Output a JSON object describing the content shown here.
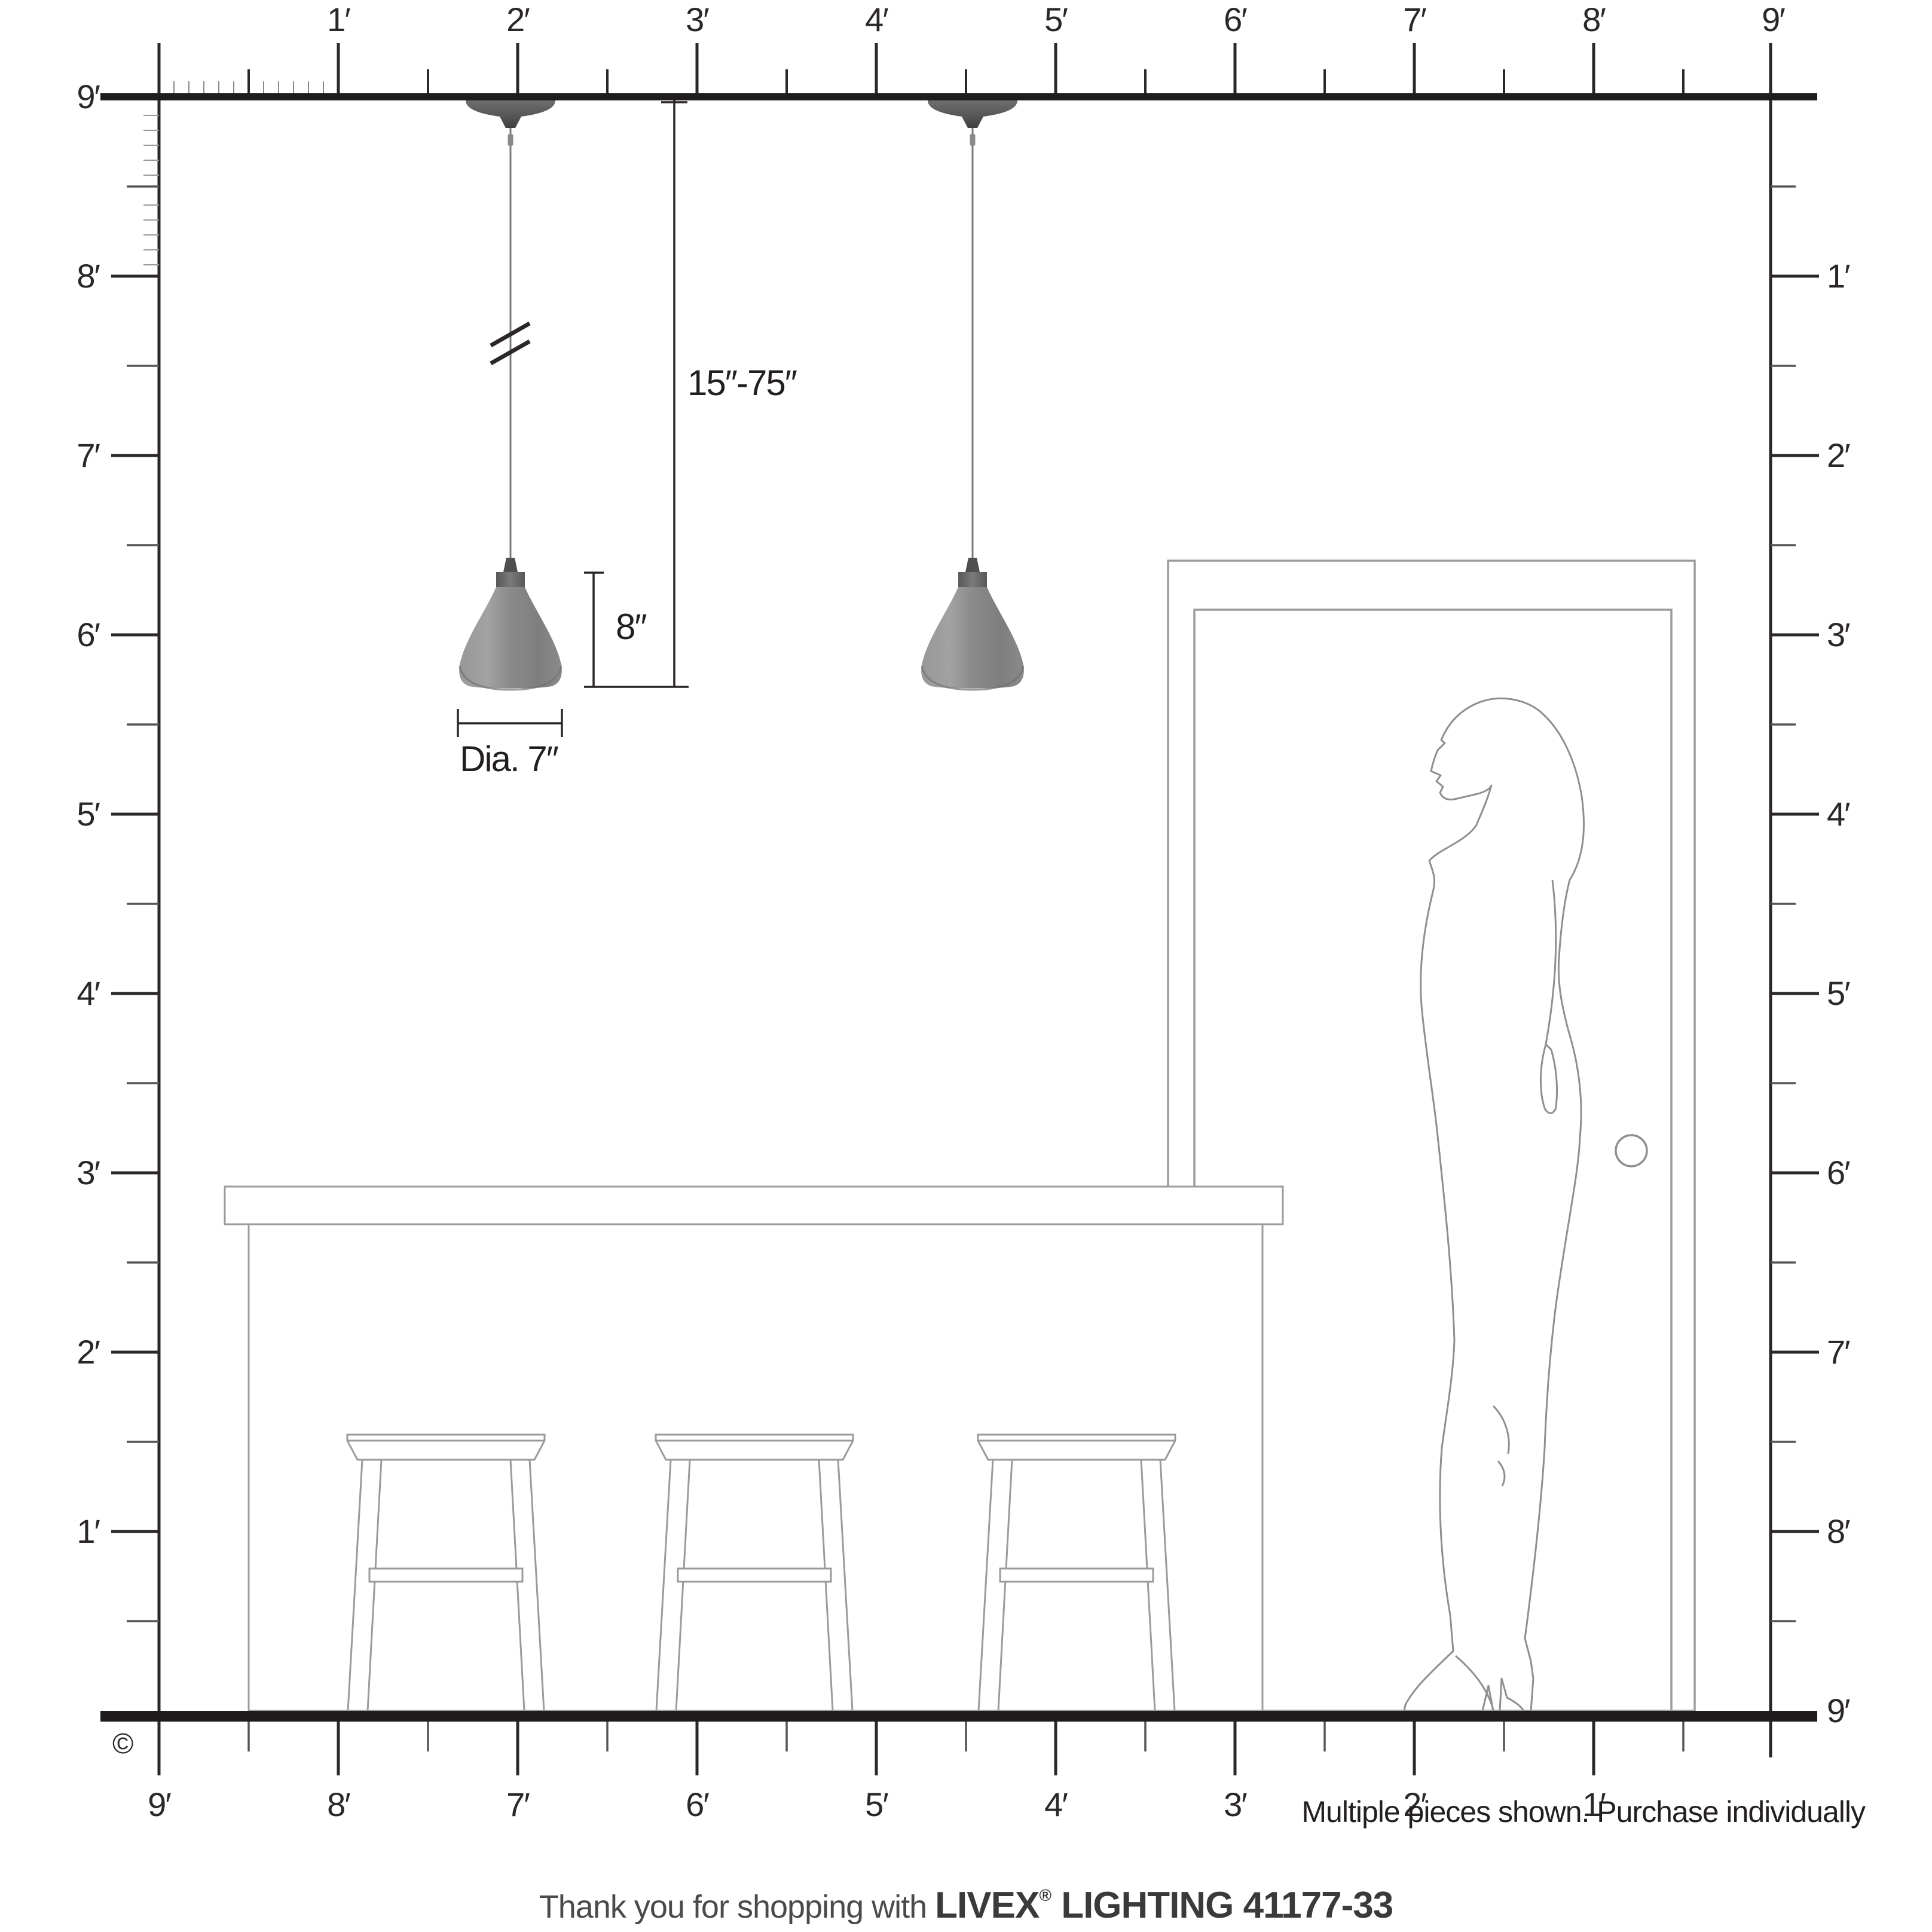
{
  "labels": {
    "top": [
      "1′",
      "2′",
      "3′",
      "4′",
      "5′",
      "6′",
      "7′",
      "8′",
      "9′"
    ],
    "left": [
      "9′",
      "8′",
      "7′",
      "6′",
      "5′",
      "4′",
      "3′",
      "2′",
      "1′"
    ],
    "right": [
      "1′",
      "2′",
      "3′",
      "4′",
      "5′",
      "6′",
      "7′",
      "8′",
      "9′"
    ],
    "bottom": [
      "9′",
      "8′",
      "7′",
      "6′",
      "5′",
      "4′",
      "3′",
      "2′",
      "1′"
    ]
  },
  "dimensions": {
    "drop": "15″-75″",
    "shade_height": "8″",
    "shade_diameter": "Dia. 7″"
  },
  "copyright": "©",
  "note": "Multiple pieces shown. Purchase individually",
  "footer": {
    "prefix": "Thank you for shopping with ",
    "brand": "LIVEX",
    "registered": "®",
    "product": " LIGHTING 41177-33"
  },
  "colors": {
    "ink": "#2b2728",
    "furniture_line": "#9b9b9b",
    "figure_line": "#8f8f8f",
    "shade_gray": "#8d8d8d",
    "canopy_gray": "#565656",
    "cord_gray": "#7a7a7a"
  }
}
